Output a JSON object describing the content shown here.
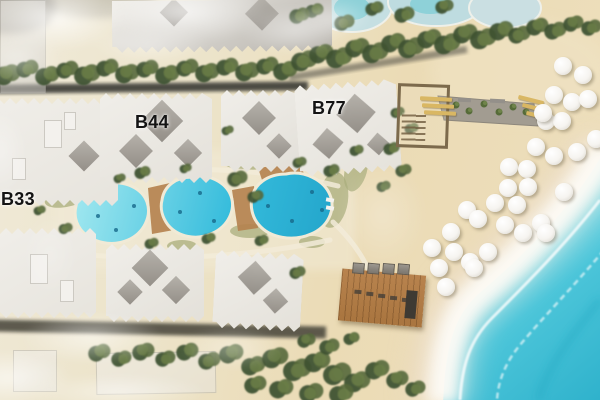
{
  "scene": {
    "description": "Aerial site-plan rendering of a beachfront resort: three labeled apartment blocks, three pools, beach promenade, beach bar, umbrellas and sea"
  },
  "labels": {
    "building_b33": "B33",
    "building_b44": "B44",
    "building_b77": "B77"
  },
  "colors": {
    "sand": "#ebdbb6",
    "sand_light": "#f0ead9",
    "sea": "#4cc5d9",
    "sea_deep": "#2fb2cc",
    "foam": "#fdfbf6",
    "pool_water": "#35bcdc",
    "pool_water_light": "#9fe7ef",
    "building_wall": "#e6e3dc",
    "building_roof_dark": "#a5a19a",
    "context_building": "#b6b2ab",
    "tree_dark": "#3f5233",
    "tree_mid": "#54683b",
    "tree_light": "#6a7d46",
    "wood_deck": "#b07b48",
    "walkway": "#a29c91",
    "road": "#3b3a36",
    "lawn": "#a9ad7c",
    "umbrella": "#ffffff",
    "lounger_gold": "#d9b763",
    "label_text": "#141414"
  },
  "map": {
    "buildings": [
      {
        "name": "context-building-northwest",
        "x": 0,
        "y": 0,
        "w": 44,
        "h": 92,
        "rot": 0,
        "fill": "#c6c3bd",
        "zig_top": false,
        "zig_bottom": false,
        "faded": true
      },
      {
        "name": "context-building-north",
        "x": 112,
        "y": 0,
        "w": 220,
        "h": 52,
        "rot": -0.5,
        "fill": "#b6b2ab",
        "zig_top": false,
        "zig_bottom": true,
        "faded": false,
        "diamonds": [
          [
            150,
            14,
            24
          ],
          [
            62,
            12,
            20
          ]
        ]
      },
      {
        "name": "building-b33",
        "x": -8,
        "y": 98,
        "w": 126,
        "h": 108,
        "rot": 0,
        "fill": "#e7e4dd",
        "zig_top": true,
        "zig_bottom": true,
        "faded": false,
        "diamonds": [
          [
            92,
            58,
            22
          ]
        ],
        "vents": [
          [
            52,
            22,
            16,
            26
          ],
          [
            20,
            60,
            12,
            20
          ],
          [
            72,
            14,
            10,
            16
          ]
        ]
      },
      {
        "name": "building-b44",
        "x": 100,
        "y": 93,
        "w": 112,
        "h": 90,
        "rot": 0,
        "fill": "#e4e1da",
        "zig_top": true,
        "zig_bottom": true,
        "faded": false,
        "diamonds": [
          [
            62,
            28,
            30
          ],
          [
            36,
            58,
            24
          ],
          [
            88,
            60,
            20
          ]
        ]
      },
      {
        "name": "building-north-center",
        "x": 221,
        "y": 90,
        "w": 80,
        "h": 82,
        "rot": 0,
        "fill": "#e2dfd8",
        "zig_top": true,
        "zig_bottom": true,
        "faded": false,
        "diamonds": [
          [
            38,
            28,
            24
          ],
          [
            58,
            56,
            18
          ]
        ]
      },
      {
        "name": "building-b77",
        "x": 297,
        "y": 82,
        "w": 102,
        "h": 92,
        "rot": -4,
        "fill": "#e5e2db",
        "zig_top": true,
        "zig_bottom": true,
        "faded": false,
        "diamonds": [
          [
            60,
            32,
            28
          ],
          [
            30,
            60,
            22
          ],
          [
            80,
            64,
            16
          ]
        ]
      },
      {
        "name": "building-south-west",
        "x": 0,
        "y": 228,
        "w": 96,
        "h": 90,
        "rot": 0,
        "fill": "#e7e4dd",
        "zig_top": true,
        "zig_bottom": true,
        "faded": false,
        "vents": [
          [
            30,
            26,
            16,
            28
          ],
          [
            60,
            52,
            12,
            20
          ]
        ]
      },
      {
        "name": "building-south-center",
        "x": 106,
        "y": 244,
        "w": 98,
        "h": 78,
        "rot": 0,
        "fill": "#e3e0d9",
        "zig_top": true,
        "zig_bottom": true,
        "faded": false,
        "diamonds": [
          [
            44,
            24,
            26
          ],
          [
            70,
            46,
            20
          ],
          [
            24,
            48,
            18
          ]
        ]
      },
      {
        "name": "building-south-east",
        "x": 214,
        "y": 252,
        "w": 88,
        "h": 78,
        "rot": 3,
        "fill": "#e4e1da",
        "zig_top": true,
        "zig_bottom": true,
        "faded": false,
        "diamonds": [
          [
            40,
            26,
            24
          ],
          [
            62,
            48,
            18
          ]
        ]
      },
      {
        "name": "context-building-south-a",
        "x": 13,
        "y": 350,
        "w": 42,
        "h": 40,
        "rot": 0,
        "fill": "#e9e6df",
        "zig_top": false,
        "zig_bottom": false,
        "faded": true
      },
      {
        "name": "context-building-south-b",
        "x": 96,
        "y": 352,
        "w": 118,
        "h": 40,
        "rot": -1,
        "fill": "#e7e4dd",
        "zig_top": false,
        "zig_bottom": false,
        "faded": true
      }
    ],
    "pools": [
      {
        "name": "pool-west"
      },
      {
        "name": "pool-center"
      },
      {
        "name": "pool-east"
      }
    ],
    "pool_specks": [
      [
        98,
        216
      ],
      [
        116,
        230
      ],
      [
        134,
        206
      ],
      [
        180,
        212
      ],
      [
        200,
        193
      ],
      [
        214,
        221
      ],
      [
        268,
        206
      ],
      [
        292,
        221
      ],
      [
        312,
        192
      ],
      [
        322,
        210
      ]
    ],
    "umbrellas": [
      [
        563,
        66
      ],
      [
        583,
        75
      ],
      [
        554,
        95
      ],
      [
        572,
        102
      ],
      [
        588,
        99
      ],
      [
        546,
        121
      ],
      [
        562,
        121
      ],
      [
        596,
        139
      ],
      [
        536,
        147
      ],
      [
        554,
        156
      ],
      [
        577,
        152
      ],
      [
        509,
        167
      ],
      [
        527,
        169
      ],
      [
        543,
        113
      ],
      [
        508,
        188
      ],
      [
        528,
        187
      ],
      [
        564,
        192
      ],
      [
        495,
        203
      ],
      [
        517,
        205
      ],
      [
        467,
        210
      ],
      [
        478,
        219
      ],
      [
        505,
        225
      ],
      [
        541,
        223
      ],
      [
        546,
        233
      ],
      [
        451,
        232
      ],
      [
        523,
        233
      ],
      [
        432,
        248
      ],
      [
        454,
        252
      ],
      [
        488,
        252
      ],
      [
        470,
        262
      ],
      [
        439,
        268
      ],
      [
        474,
        268
      ],
      [
        446,
        287
      ]
    ],
    "trees": [
      [
        8,
        74,
        13
      ],
      [
        28,
        68,
        11
      ],
      [
        48,
        75,
        12
      ],
      [
        68,
        69,
        11
      ],
      [
        88,
        74,
        13
      ],
      [
        108,
        67,
        11
      ],
      [
        128,
        73,
        12
      ],
      [
        148,
        68,
        11
      ],
      [
        168,
        74,
        12
      ],
      [
        188,
        67,
        11
      ],
      [
        208,
        72,
        12
      ],
      [
        228,
        66,
        11
      ],
      [
        248,
        71,
        12
      ],
      [
        268,
        65,
        11
      ],
      [
        286,
        70,
        12
      ],
      [
        305,
        60,
        13
      ],
      [
        322,
        53,
        12
      ],
      [
        340,
        57,
        13
      ],
      [
        358,
        47,
        12
      ],
      [
        376,
        52,
        13
      ],
      [
        394,
        42,
        12
      ],
      [
        412,
        47,
        13
      ],
      [
        430,
        38,
        12
      ],
      [
        448,
        43,
        13
      ],
      [
        466,
        33,
        12
      ],
      [
        484,
        38,
        13
      ],
      [
        502,
        30,
        12
      ],
      [
        520,
        34,
        11
      ],
      [
        538,
        26,
        11
      ],
      [
        556,
        30,
        11
      ],
      [
        574,
        23,
        10
      ],
      [
        592,
        27,
        10
      ],
      [
        315,
        10,
        9
      ],
      [
        345,
        22,
        10
      ],
      [
        375,
        8,
        9
      ],
      [
        405,
        14,
        10
      ],
      [
        445,
        6,
        9
      ],
      [
        300,
        15,
        10
      ],
      [
        143,
        172,
        8
      ],
      [
        238,
        178,
        10
      ],
      [
        256,
        196,
        8
      ],
      [
        332,
        170,
        8
      ],
      [
        300,
        162,
        7
      ],
      [
        228,
        130,
        6
      ],
      [
        357,
        150,
        7
      ],
      [
        66,
        228,
        7
      ],
      [
        152,
        243,
        7
      ],
      [
        262,
        240,
        7
      ],
      [
        120,
        178,
        6
      ],
      [
        186,
        168,
        6
      ],
      [
        209,
        238,
        7
      ],
      [
        298,
        272,
        8
      ],
      [
        40,
        210,
        6
      ],
      [
        392,
        148,
        8
      ],
      [
        404,
        170,
        8
      ],
      [
        384,
        186,
        7
      ],
      [
        412,
        128,
        7
      ],
      [
        398,
        112,
        7
      ],
      [
        100,
        352,
        11
      ],
      [
        122,
        358,
        10
      ],
      [
        144,
        351,
        11
      ],
      [
        166,
        358,
        10
      ],
      [
        188,
        351,
        11
      ],
      [
        210,
        360,
        11
      ],
      [
        232,
        353,
        12
      ],
      [
        254,
        365,
        12
      ],
      [
        276,
        357,
        13
      ],
      [
        298,
        369,
        14
      ],
      [
        318,
        361,
        13
      ],
      [
        338,
        373,
        14
      ],
      [
        358,
        381,
        13
      ],
      [
        378,
        369,
        12
      ],
      [
        398,
        379,
        11
      ],
      [
        416,
        388,
        10
      ],
      [
        282,
        388,
        12
      ],
      [
        312,
        392,
        12
      ],
      [
        256,
        384,
        11
      ],
      [
        342,
        393,
        12
      ],
      [
        307,
        340,
        9
      ],
      [
        330,
        346,
        10
      ],
      [
        352,
        338,
        8
      ]
    ],
    "lawns": [
      [
        70,
        196,
        26,
        10,
        -15
      ],
      [
        152,
        167,
        20,
        8,
        -5
      ],
      [
        243,
        162,
        22,
        8,
        5
      ],
      [
        333,
        200,
        15,
        28,
        8
      ],
      [
        250,
        231,
        20,
        7,
        0
      ],
      [
        182,
        246,
        15,
        6,
        0
      ],
      [
        312,
        242,
        13,
        6,
        0
      ],
      [
        356,
        170,
        11,
        22,
        15
      ],
      [
        60,
        180,
        14,
        7,
        -20
      ],
      [
        290,
        128,
        10,
        5,
        0
      ]
    ],
    "fog": [
      [
        55,
        18,
        70,
        34,
        0.78
      ],
      [
        185,
        12,
        85,
        32,
        0.72
      ],
      [
        296,
        30,
        55,
        25,
        0.5
      ],
      [
        18,
        58,
        45,
        28,
        0.45
      ],
      [
        150,
        45,
        60,
        20,
        0.4
      ],
      [
        92,
        338,
        72,
        26,
        0.55
      ],
      [
        8,
        378,
        65,
        28,
        0.62
      ],
      [
        232,
        348,
        52,
        22,
        0.38
      ],
      [
        332,
        18,
        40,
        20,
        0.45
      ],
      [
        0,
        152,
        28,
        44,
        0.35
      ],
      [
        120,
        392,
        90,
        18,
        0.5
      ],
      [
        382,
        215,
        46,
        55,
        0.28
      ],
      [
        50,
        255,
        30,
        45,
        0.2
      ]
    ],
    "walkway_plants": [
      [
        456,
        105
      ],
      [
        469,
        111
      ],
      [
        484,
        104
      ],
      [
        499,
        112
      ],
      [
        513,
        107
      ],
      [
        526,
        112
      ]
    ],
    "loungers": [
      [
        420,
        97,
        32,
        4,
        3
      ],
      [
        422,
        104,
        32,
        4,
        3
      ],
      [
        424,
        111,
        32,
        4,
        3
      ],
      [
        518,
        98,
        26,
        4,
        14
      ],
      [
        522,
        106,
        26,
        4,
        14
      ],
      [
        526,
        114,
        26,
        4,
        14
      ]
    ],
    "beach_bar": {
      "furniture": [
        [
          10,
          -7
        ],
        [
          25,
          -8
        ],
        [
          40,
          -9
        ],
        [
          55,
          -10
        ]
      ],
      "marks": [
        [
          14,
          20
        ],
        [
          26,
          21
        ],
        [
          38,
          22
        ],
        [
          50,
          23
        ],
        [
          62,
          24
        ]
      ],
      "counter": [
        66,
        16,
        11,
        28
      ]
    }
  }
}
